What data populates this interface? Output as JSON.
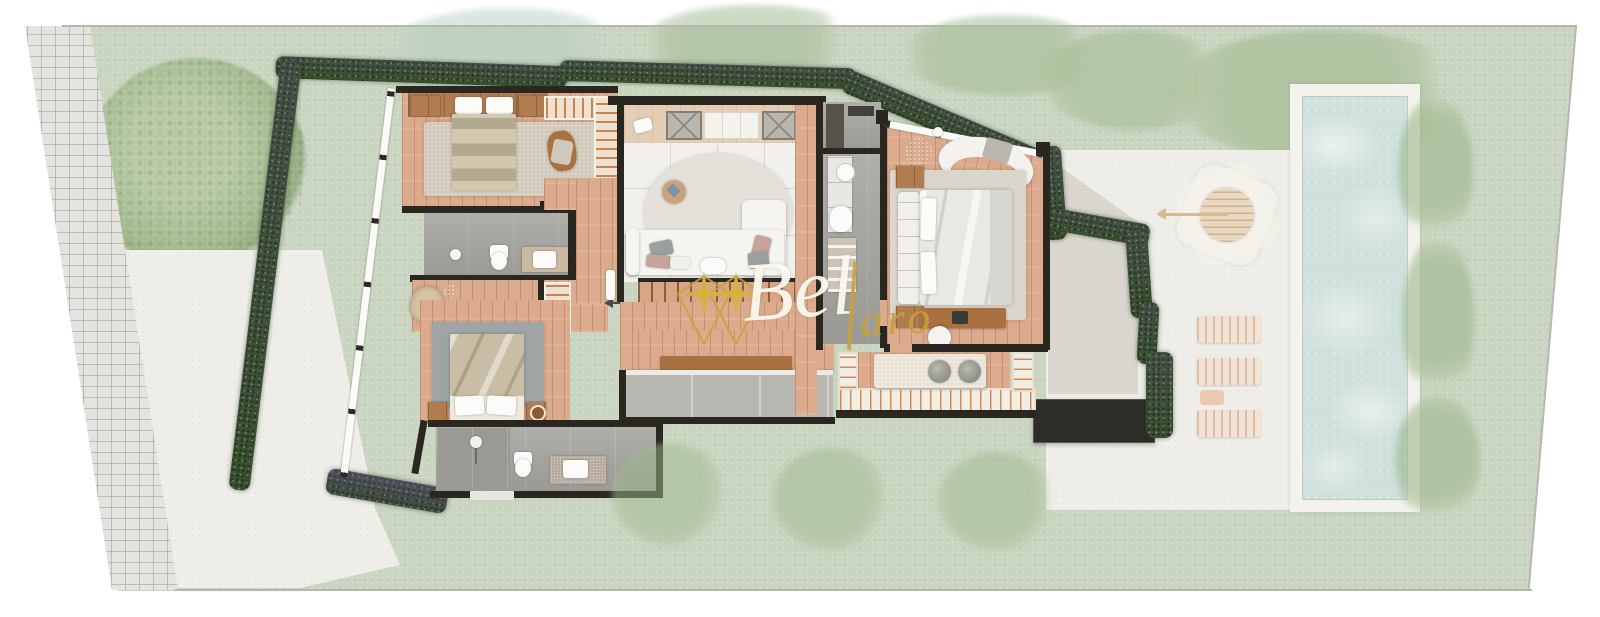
{
  "document": {
    "type": "architectural floor-plan rendering",
    "view": "top-down upper floor of a villa on landscaped plot with pool",
    "visible_text_labels": []
  },
  "watermark": {
    "script_text": "Bel",
    "accent_text": "aro",
    "logo": "gold diamond monogram with two sparkle stars",
    "script_color": "#fcf9f0",
    "accent_color": "#c9a13b"
  },
  "palette": {
    "background": "#ffffff",
    "lawn": "#cad5c1",
    "paver_path": "#e3e3df",
    "concrete_terrace": "#eeede8",
    "wood_floor": "#dcab8d",
    "deck_slats": "#c9834f",
    "walls": "#29271f",
    "hedge": "#46603b",
    "pool_water": "#cfe0dd",
    "pool_deck": "#f4f2ec",
    "rug_beige": "#d8d1c3",
    "rug_gray": "#9fa5a5",
    "rug_light": "#e4e1da",
    "furniture_wood": "#a9713f",
    "upholstery_white": "#f5f4f1",
    "pillow_gray": "#9aa0a0",
    "pillow_blush": "#c7a49b",
    "bathroom_floor": "#a6a5a0",
    "fixture_white": "#fbfbf9",
    "dark_roof": "#2e2c26",
    "gold": "#c9a13b"
  },
  "site": {
    "features": [
      {
        "id": "paver-path",
        "desc": "basketweave brick walkway, left edge, slanted"
      },
      {
        "id": "big-tree",
        "desc": "large round tree canopy, top-left lawn"
      },
      {
        "id": "lawn",
        "desc": "pale green grass over whole plot with faded tree canopies"
      },
      {
        "id": "perimeter-hedge",
        "desc": "dark green hedge with purple flower accents hugging house walls"
      },
      {
        "id": "driveway-slab",
        "desc": "white concrete area left of house"
      },
      {
        "id": "pool-terrace",
        "desc": "white concrete terrace right of house"
      },
      {
        "id": "pool",
        "desc": "long rectangular pool with white deck, right side"
      },
      {
        "id": "parasol-table",
        "desc": "round table with octagonal parasol and pole arrow"
      },
      {
        "id": "sun-loungers",
        "count": 3
      },
      {
        "id": "flat-roof",
        "desc": "dark charcoal flat roof volume, lower right of house"
      }
    ]
  },
  "rooms": [
    {
      "id": "bedroom-1",
      "floor": "wood",
      "furniture": [
        "wardrobe-strip",
        "nightstand-left",
        "nightstand-right",
        "double-bed-striped-duvet",
        "area-rug",
        "lounge-chair",
        "wall-tv",
        "slatted-balcony"
      ]
    },
    {
      "id": "bathroom-1",
      "floor": "gray-stone",
      "furniture": [
        "floor-lamp",
        "toilet",
        "vanity-with-sink"
      ]
    },
    {
      "id": "hallway",
      "floor": "wood",
      "furniture": [
        "armchair",
        "potted-plant",
        "garden-stair-slats"
      ]
    },
    {
      "id": "bedroom-2",
      "floor": "wood",
      "furniture": [
        "unmade-double-bed",
        "gray-area-rug",
        "nightstand-left",
        "nightstand-right"
      ]
    },
    {
      "id": "bathroom-2",
      "floor": "gray-stone",
      "furniture": [
        "walk-in-shower",
        "toilet",
        "stone-vanity-with-sink"
      ]
    },
    {
      "id": "living-room",
      "floor": "white-tile",
      "furniture": [
        "skylight-grille-1",
        "media-sideboard",
        "skylight-grille-2",
        "floor-book",
        "potted-plant",
        "round-speckled-rug",
        "side-table",
        "corner-sofa",
        "throw-pillows",
        "side-table-white"
      ]
    },
    {
      "id": "stair-hall",
      "floor": "wood",
      "furniture": [
        "staircase-down-arrow",
        "long-bench",
        "balcony-ledge"
      ]
    },
    {
      "id": "utility-room",
      "floor": "gray-stone",
      "furniture": [
        "dark-counter"
      ]
    },
    {
      "id": "master-bathroom",
      "floor": "gray-stone",
      "furniture": [
        "round-sink",
        "counter",
        "bathtub",
        "linen-shelf"
      ]
    },
    {
      "id": "master-bedroom",
      "floor": "wood",
      "furniture": [
        "panoramic-window",
        "curved-sofa",
        "potted-plant",
        "pendant-light",
        "upholstered-headboard-bed",
        "nightstand-top",
        "nightstand-bottom",
        "area-rug",
        "desk",
        "laptop",
        "desk-chair"
      ]
    },
    {
      "id": "terrace-bar",
      "floor": "wood-deck",
      "furniture": [
        "counter-island",
        "stool-1",
        "stool-2",
        "deck-railing"
      ]
    }
  ]
}
